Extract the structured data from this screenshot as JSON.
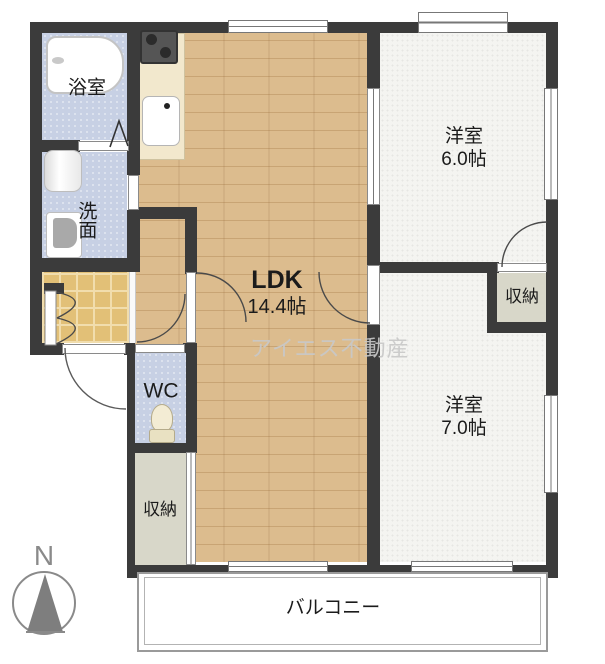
{
  "floorplan": {
    "watermark": "アイエス不動産",
    "compass": {
      "label": "N"
    },
    "rooms": {
      "bath": {
        "label": "浴室"
      },
      "washroom": {
        "label": "洗面"
      },
      "wc": {
        "label": "WC"
      },
      "storage_left": {
        "label": "収納"
      },
      "storage_right": {
        "label": "収納"
      },
      "ldk": {
        "label": "LDK",
        "size": "14.4帖"
      },
      "bedroom_north": {
        "label": "洋室",
        "size": "6.0帖"
      },
      "bedroom_south": {
        "label": "洋室",
        "size": "7.0帖"
      },
      "balcony": {
        "label": "バルコニー"
      }
    },
    "icons": [
      "bathtub-icon",
      "stove-icon",
      "kitchen-sink-icon",
      "washing-machine-icon",
      "vanity-sink-icon",
      "toilet-icon",
      "north-arrow-icon",
      "door-swing-arc",
      "folding-door-mark"
    ],
    "colors": {
      "wall": "#3b3b3b",
      "wood_floor": "#dcbc8e",
      "wet_area_floor": "#c7d0e4",
      "storage_floor": "#d8d7c9",
      "entrance_tile": "#e2c077",
      "bedroom_floor": "#f4f4f1",
      "kitchen_counter": "#f2e8cd",
      "watermark_text": "#c8c8c8"
    }
  }
}
